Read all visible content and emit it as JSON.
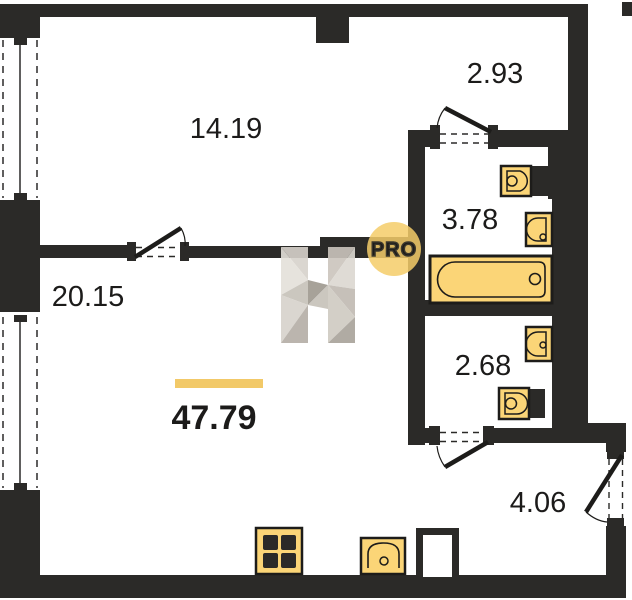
{
  "floorplan": {
    "type": "apartment-floor-plan",
    "total_area": {
      "value": "47.79"
    },
    "rooms": [
      {
        "name": "living-room",
        "area": "14.19"
      },
      {
        "name": "upper-hall",
        "area": "2.93"
      },
      {
        "name": "bathroom",
        "area": "3.78"
      },
      {
        "name": "kitchen-living",
        "area": "20.15"
      },
      {
        "name": "wc",
        "area": "2.68"
      },
      {
        "name": "entry-hallway",
        "area": "4.06"
      }
    ],
    "badge": {
      "label": "PRO"
    },
    "fixtures": [
      "bathtub",
      "washbasin",
      "bathroom-sink",
      "wc-sink",
      "toilet",
      "stove",
      "kitchen-sink",
      "ventilation-shaft"
    ],
    "colors": {
      "wall": "#2b2a28",
      "fixture_fill": "#fbd577",
      "fixture_stroke": "#1d1c1a",
      "accent_bar": "#f2c968",
      "badge_fill": "#f4cc69",
      "watermark_grays": [
        "#e4e0da",
        "#d7d2cb",
        "#c6c1b9",
        "#b4aea6",
        "#9e988f"
      ]
    }
  }
}
